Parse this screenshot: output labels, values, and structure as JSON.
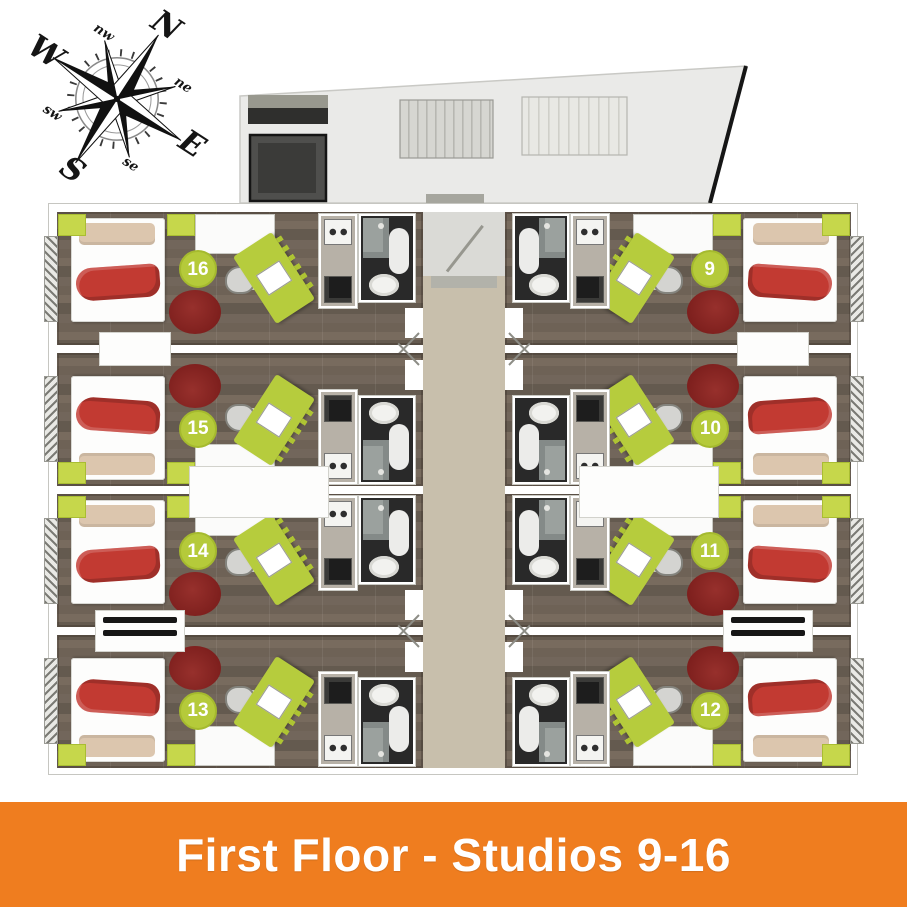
{
  "banner": {
    "title": "First Floor - Studios 9-16",
    "background": "#ef7d1f",
    "text_color": "#ffffff"
  },
  "compass": {
    "cardinal": [
      "N",
      "E",
      "S",
      "W"
    ],
    "intercardinal": [
      "nw",
      "ne",
      "se",
      "sw"
    ]
  },
  "plan": {
    "floor_label": "First Floor",
    "studio_range": "9-16",
    "studios": [
      {
        "number": "16",
        "column": "left",
        "row": 1
      },
      {
        "number": "15",
        "column": "left",
        "row": 2
      },
      {
        "number": "14",
        "column": "left",
        "row": 3
      },
      {
        "number": "13",
        "column": "left",
        "row": 4
      },
      {
        "number": "9",
        "column": "right",
        "row": 1
      },
      {
        "number": "10",
        "column": "right",
        "row": 2
      },
      {
        "number": "11",
        "column": "right",
        "row": 3
      },
      {
        "number": "12",
        "column": "right",
        "row": 4
      }
    ],
    "colors": {
      "accent_lime": "#b5ca3a",
      "rug_red": "#7d1f1d",
      "blanket_red": "#c23a32",
      "floor_wood": "#6e6256",
      "corridor_beige": "#c8bfac",
      "bathroom_dark": "#292929"
    }
  }
}
